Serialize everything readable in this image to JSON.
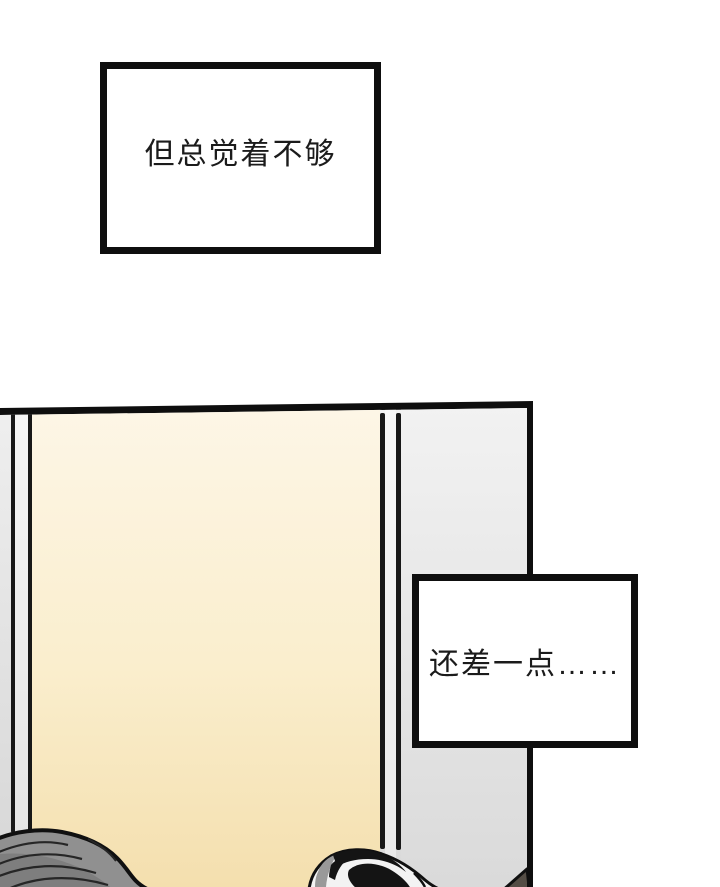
{
  "page": {
    "kind": "comic-page",
    "background_color": "#ffffff"
  },
  "captions": [
    {
      "id": "caption-1",
      "text": "但总觉着不够",
      "border_color": "#0e0e0e",
      "fill_color": "#ffffff",
      "text_color": "#1b1b1b"
    },
    {
      "id": "caption-2",
      "text": "还差一点……",
      "border_color": "#0e0e0e",
      "fill_color": "#ffffff",
      "text_color": "#1b1b1b"
    }
  ],
  "panel": {
    "border_color": "#0e0e0e",
    "walls": {
      "cream_wall_top": "#fdf6e7",
      "cream_wall_bottom": "#f4dfae",
      "gray_wall_top": "#f2f2f2",
      "gray_wall_bottom": "#dadada",
      "trim_line_color": "#181818"
    },
    "figures": [
      {
        "name": "gray-hair-head",
        "hair_color": "#909090",
        "outline_color": "#101010"
      },
      {
        "name": "dark-swirl-hair-head",
        "hair_colors": [
          "#141414",
          "#f3f3f3",
          "#999999"
        ],
        "outline_color": "#101010"
      },
      {
        "name": "corner-hair-wedge",
        "fill_color": "#544d45"
      }
    ]
  }
}
